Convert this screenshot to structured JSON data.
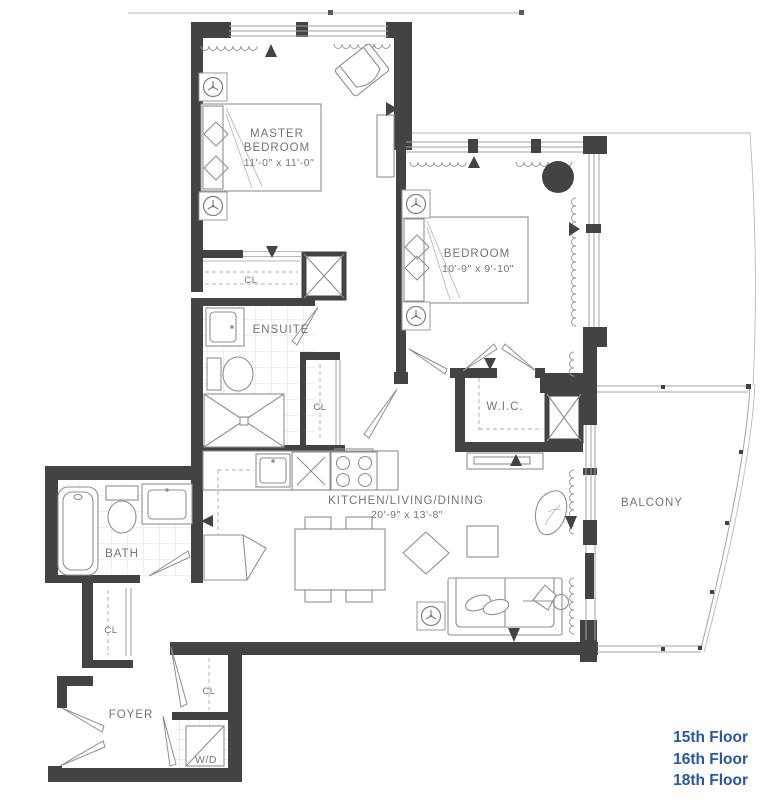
{
  "rooms": {
    "master": {
      "line1": "MASTER",
      "line2": "BEDROOM",
      "dims": "11'-0\" x 11'-0\""
    },
    "bedroom": {
      "label": "BEDROOM",
      "dims": "10'-9\" x 9'-10\""
    },
    "kitchen": {
      "label": "KITCHEN/LIVING/DINING",
      "dims": "20'-9\" x 13'-8\""
    },
    "ensuite": {
      "label": "ENSUITE"
    },
    "wic": {
      "label": "W.I.C."
    },
    "bath": {
      "label": "BATH"
    },
    "balcony": {
      "label": "BALCONY"
    },
    "foyer": {
      "label": "FOYER"
    },
    "laundry": {
      "label": "W/D"
    }
  },
  "closets": {
    "master": "CL",
    "hall": "CL",
    "bath": "CL",
    "foyer": "CL"
  },
  "floor_links": [
    "15th Floor",
    "16th Floor",
    "18th Floor"
  ],
  "colors": {
    "wall": "#434345",
    "furniture_line": "#909092",
    "label_text": "#747477",
    "link_blue": "#2a56a5"
  }
}
